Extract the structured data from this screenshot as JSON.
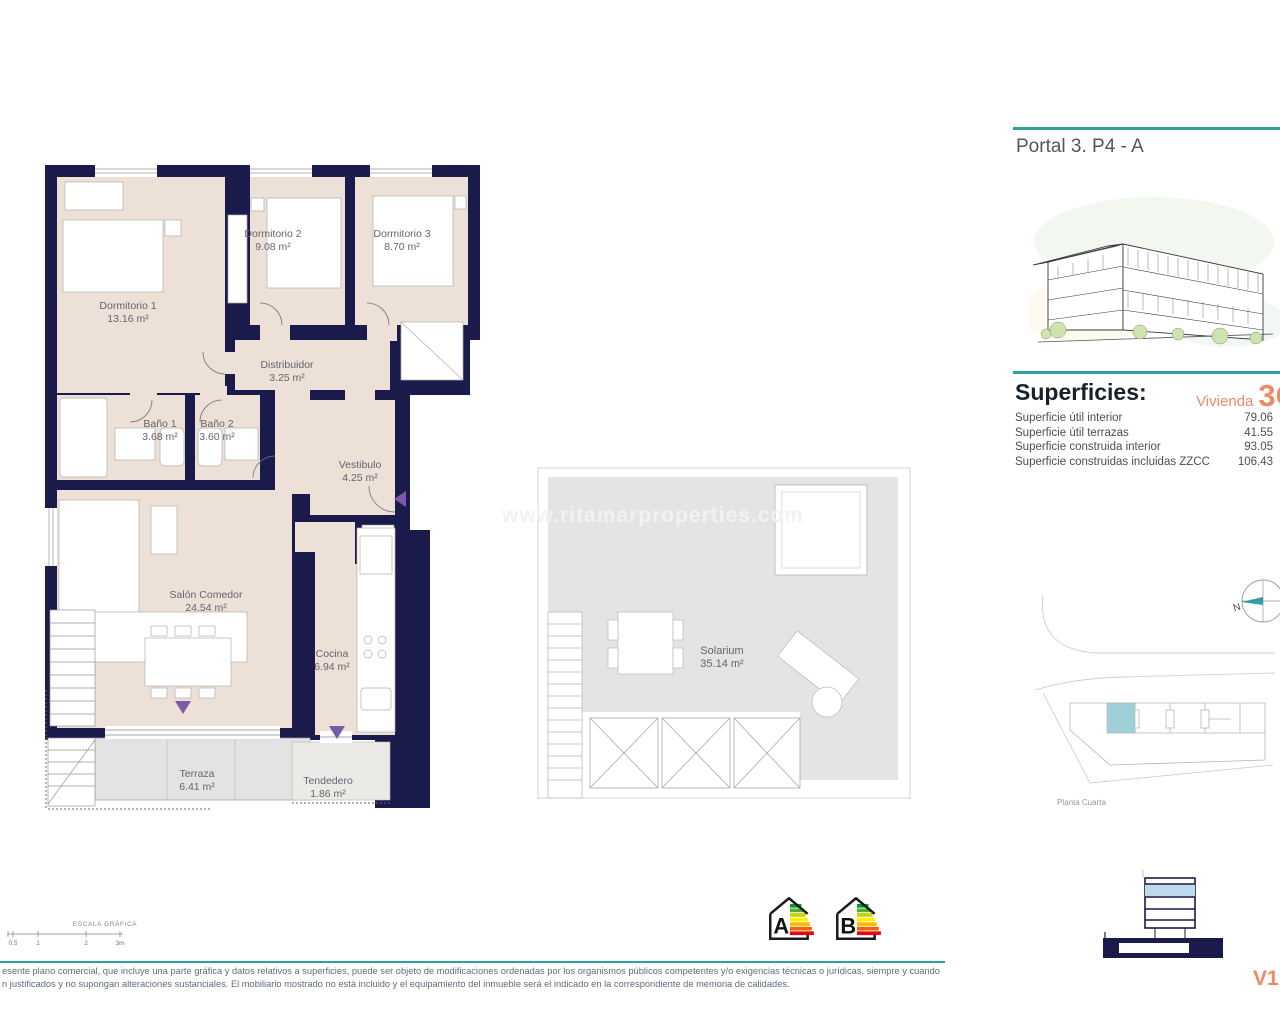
{
  "header": {
    "title": "Portal 3. P4 - A"
  },
  "superficies": {
    "title": "Superficies:",
    "vivienda_label": "Vivienda",
    "vivienda_code": "3C",
    "rows": [
      {
        "label": "Superficie útil interior",
        "value": "79.06"
      },
      {
        "label": "Superficie útil terrazas",
        "value": "41.55"
      },
      {
        "label": "Superficie construida interior",
        "value": "93.05"
      },
      {
        "label": "Superficie construidas incluidas ZZCC",
        "value": "106.43"
      }
    ]
  },
  "floor_plan": {
    "rooms": [
      {
        "name": "Dormitorio 1",
        "area": "13.16 m²"
      },
      {
        "name": "Dormitorio 2",
        "area": "9.08 m²"
      },
      {
        "name": "Dormitorio 3",
        "area": "8.70 m²"
      },
      {
        "name": "Distribuidor",
        "area": "3.25 m²"
      },
      {
        "name": "Baño 1",
        "area": "3.68 m²"
      },
      {
        "name": "Baño 2",
        "area": "3.60 m²"
      },
      {
        "name": "Vestibulo",
        "area": "4.25 m²"
      },
      {
        "name": "Salón Comedor",
        "area": "24.54 m²"
      },
      {
        "name": "Cocina",
        "area": "6.94 m²"
      },
      {
        "name": "Terraza",
        "area": "6.41 m²"
      },
      {
        "name": "Tendedero",
        "area": "1.86 m²"
      }
    ]
  },
  "solarium": {
    "name": "Solarium",
    "area": "35.14 m²"
  },
  "watermark": "www.ritamarproperties.com",
  "site_plan": {
    "compass_label": "N",
    "caption": "Planta Cuarta"
  },
  "scale_bar": {
    "title": "ESCALA GRÁFICA",
    "ticks": [
      "0.5",
      "1",
      "2",
      "3m"
    ]
  },
  "energy_rating": {
    "labels": [
      "A",
      "B"
    ]
  },
  "footer": {
    "line1": "esente plano comercial, que incluye una parte gráfica y datos relativos a superficies, puede ser objeto de modificaciones ordenadas por los organismos públicos competentes y/o exigencias técnicas o jurídicas, siempre y cuando",
    "line2": "n justificados y no supongan alteraciones sustanciales. El mobiliario mostrado no está incluido y el equipamiento del inmueble será el indicado en la correspondiente de memoria de calidades.",
    "version": "V1"
  },
  "colors": {
    "wall": "#1a1a4b",
    "room": "#ece0d7",
    "terrace": "#e3e3e3",
    "teal": "#2f9fa0",
    "orange": "#ef8a64",
    "purple": "#7a5ba8",
    "unit_highlight": "#9fd0d8",
    "elevation_highlight": "#bdd9ec"
  }
}
